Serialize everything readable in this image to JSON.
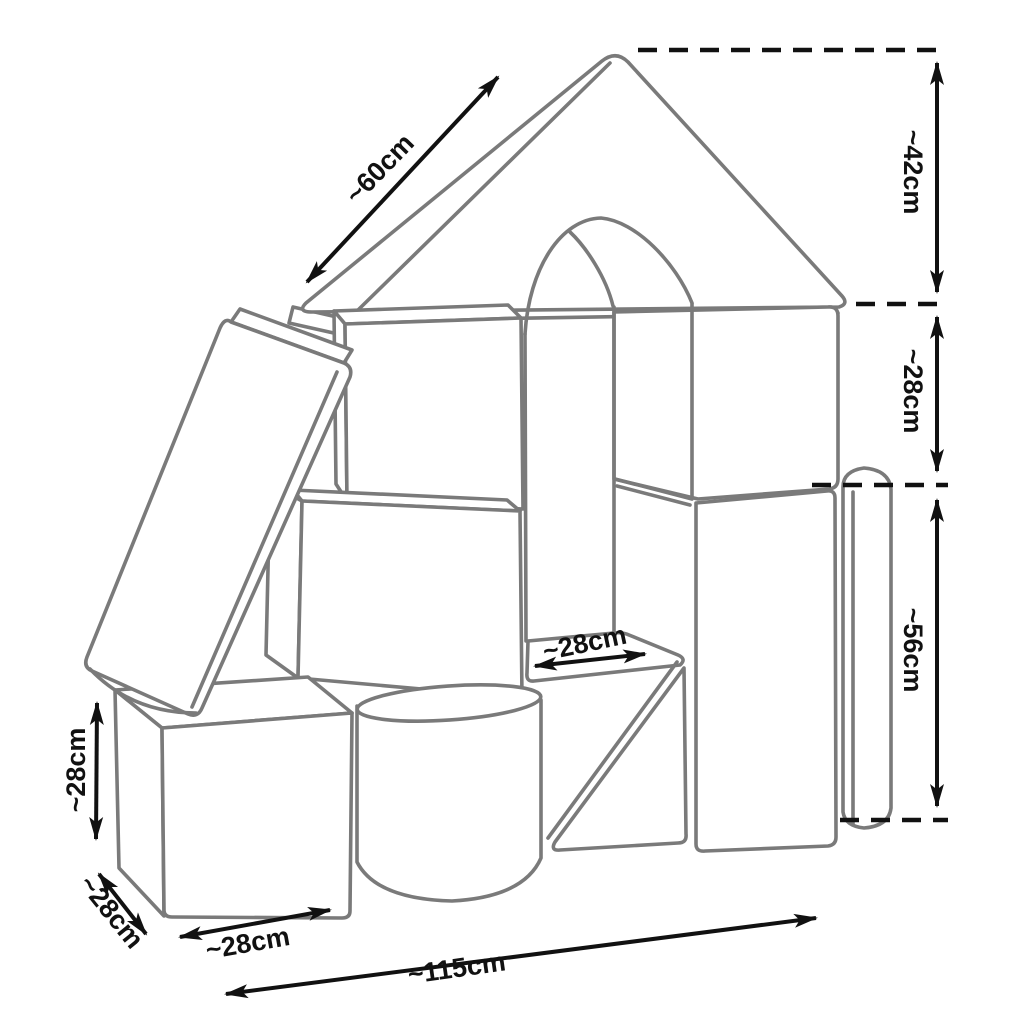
{
  "diagram": {
    "background": "#ffffff",
    "outline_color": "#7a7a7a",
    "dimension_color": "#111111",
    "shapes": [
      "roof-prism",
      "arch-block",
      "cube-blocks",
      "leaning-plank",
      "cylinder-block",
      "wedge-block",
      "rounded-column-block"
    ],
    "dimensions": {
      "roof_slope_length": "~60cm",
      "roof_height": "~42cm",
      "middle_block_height": "~28cm",
      "column_height": "~56cm",
      "step_depth": "~28cm",
      "cube_height": "~28cm",
      "cube_depth": "~28cm",
      "cube_width": "~28cm",
      "total_width": "~115cm"
    }
  }
}
